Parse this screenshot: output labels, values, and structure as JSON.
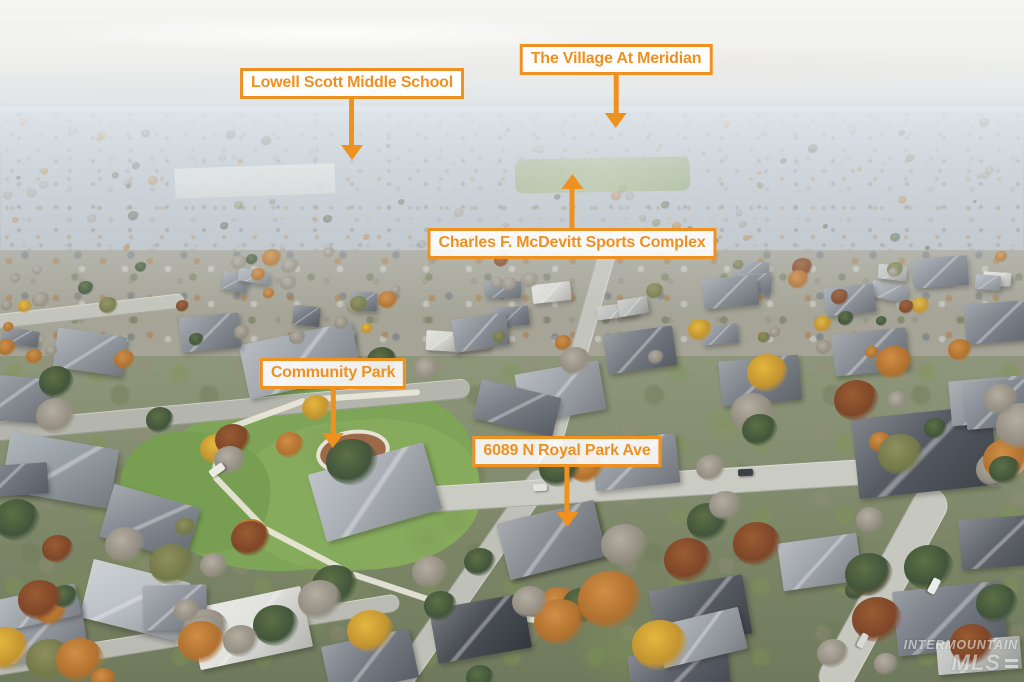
{
  "scene": {
    "description": "Aerial drone photo of an autumn suburban neighborhood with real-estate location callouts",
    "watermark": {
      "line1": "INTERMOUNTAIN",
      "line2": "MLS"
    }
  },
  "annotations": {
    "accent_color": "#EF9120",
    "label_background": "rgba(255,255,255,0.88)",
    "labels": [
      {
        "id": "lowell-scott-middle-school",
        "text": "Lowell Scott Middle School",
        "arrow": "down"
      },
      {
        "id": "the-village-at-meridian",
        "text": "The Village At Meridian",
        "arrow": "down"
      },
      {
        "id": "charles-f-mcdevitt-sports-complex",
        "text": "Charles F. McDevitt Sports Complex",
        "arrow": "up"
      },
      {
        "id": "community-park",
        "text": "Community Park",
        "arrow": "down"
      },
      {
        "id": "property-address",
        "text": "6089 N Royal Park Ave",
        "arrow": "down"
      }
    ]
  }
}
